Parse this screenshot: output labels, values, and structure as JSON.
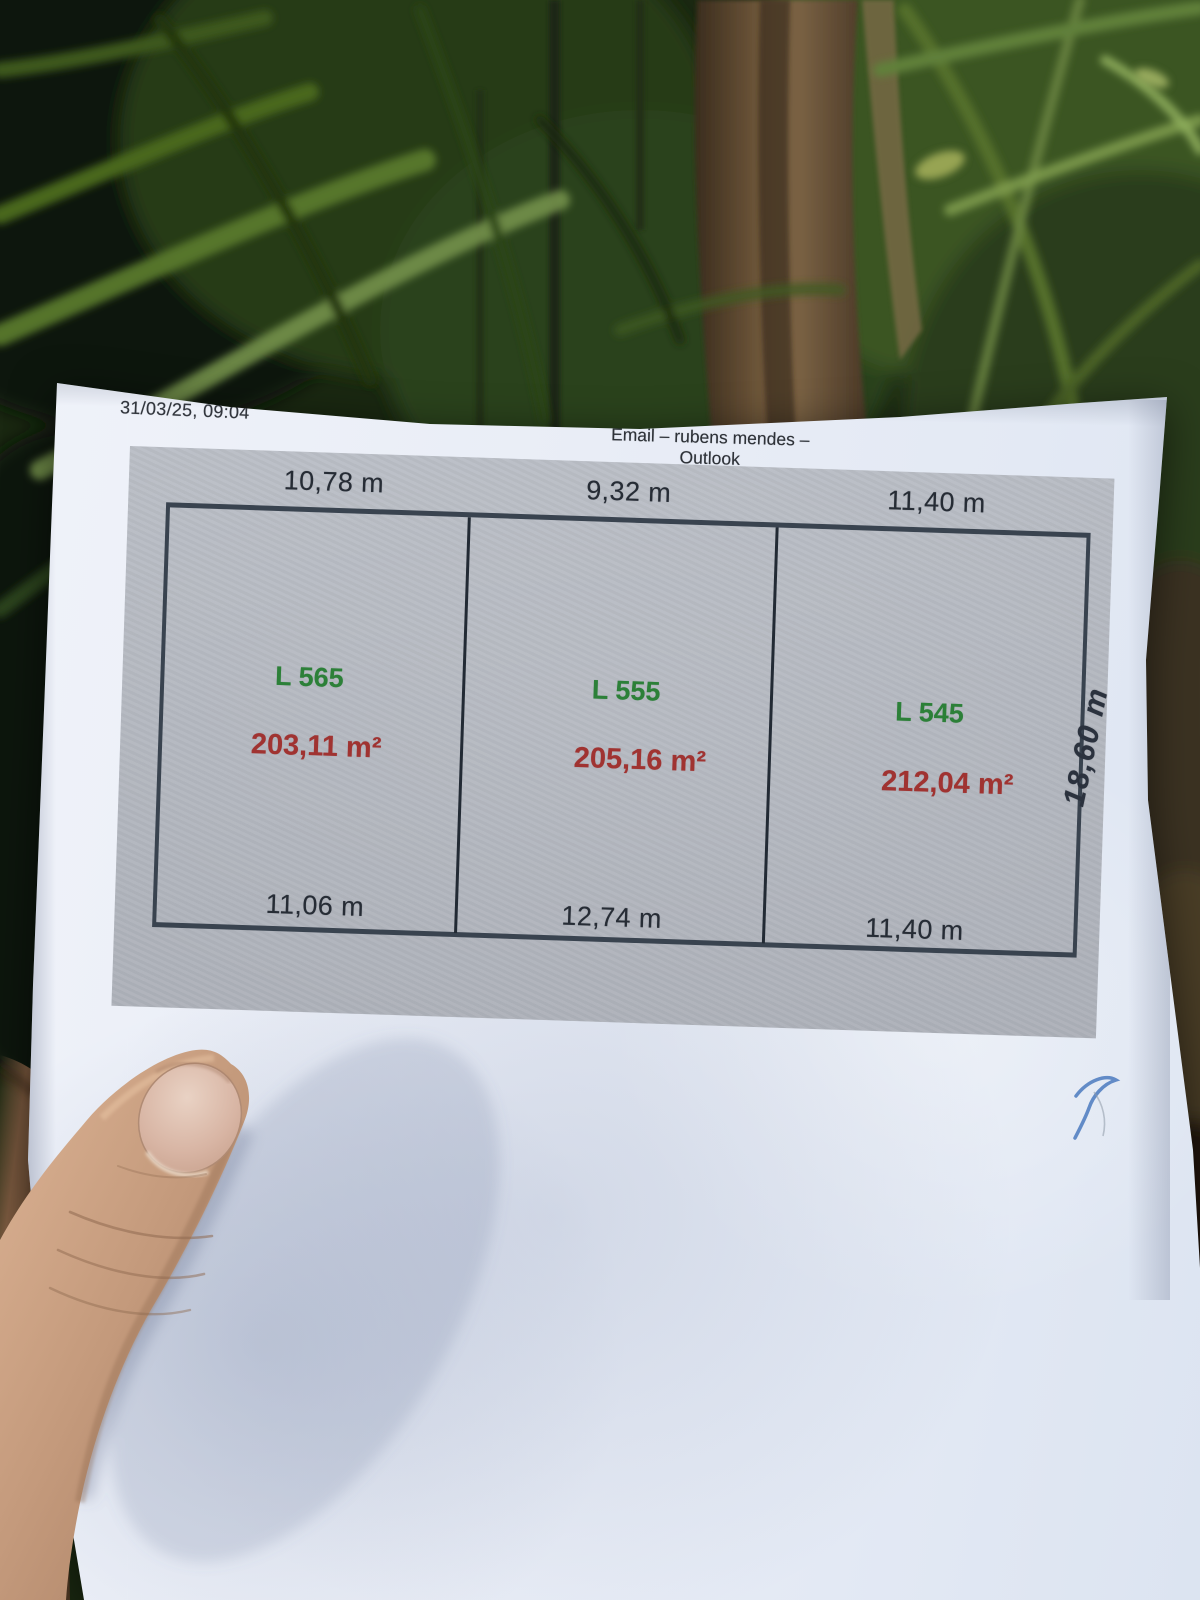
{
  "header": {
    "datetime": "31/03/25, 09:04",
    "title": "Email – rubens mendes – Outlook"
  },
  "diagram": {
    "lots": [
      {
        "id": "L 565",
        "area": "203,11 m²",
        "top_width": "10,78 m",
        "bottom_width": "11,06 m"
      },
      {
        "id": "L 555",
        "area": "205,16 m²",
        "top_width": "9,32 m",
        "bottom_width": "12,74 m"
      },
      {
        "id": "L 545",
        "area": "212,04 m²",
        "top_width": "11,40 m",
        "bottom_width": "11,40 m",
        "side_depth": "18,60 m"
      }
    ],
    "colors": {
      "lot_id_green": "#2c8038",
      "area_red": "#a03331",
      "outline": "#39434f",
      "panel_gray": "#b4b8c0",
      "paper": "#e9edf6"
    }
  },
  "scene": {
    "background": "foliage-background",
    "stalk": "plant-stalk",
    "hand": "hand-holding-paper",
    "nail": "thumb-nail",
    "pen_mark_color": "#5b86c4",
    "skin_tone": "#c49a7c"
  }
}
